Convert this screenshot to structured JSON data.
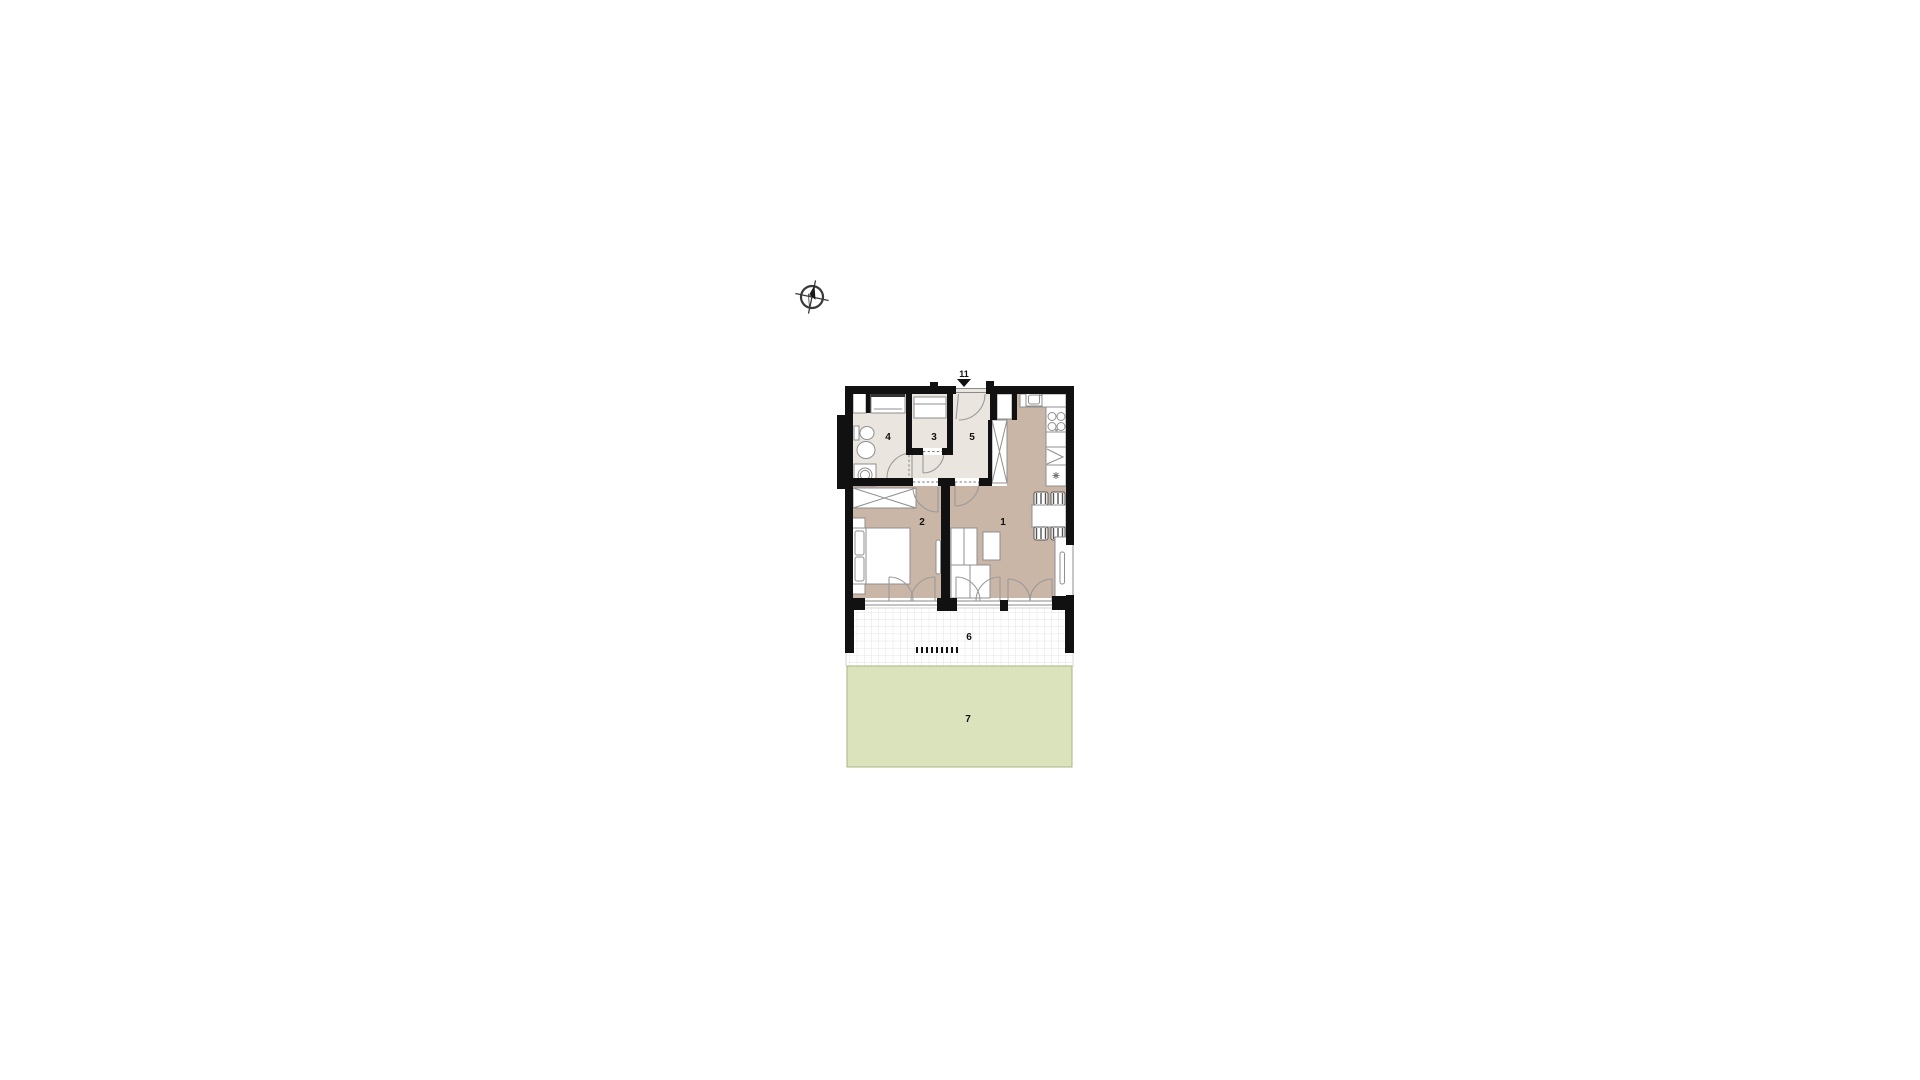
{
  "plan": {
    "entrance": {
      "label": "11"
    },
    "rooms": [
      {
        "id": "living-room",
        "label": "1"
      },
      {
        "id": "bedroom",
        "label": "2"
      },
      {
        "id": "hall-closet",
        "label": "3"
      },
      {
        "id": "bathroom",
        "label": "4"
      },
      {
        "id": "entry-hall",
        "label": "5"
      },
      {
        "id": "terrace",
        "label": "6"
      },
      {
        "id": "garden",
        "label": "7"
      }
    ],
    "colors": {
      "wall": "#111111",
      "floor_tan": "#c9b6a7",
      "floor_light": "#eae6df",
      "garden": "#dbe3bc",
      "garden_border": "#a9b585",
      "terrace_grid": "#dcdcdc"
    },
    "icons": {
      "compass": "compass-rose-icon",
      "entrance_marker": "entrance-arrow-icon"
    }
  }
}
